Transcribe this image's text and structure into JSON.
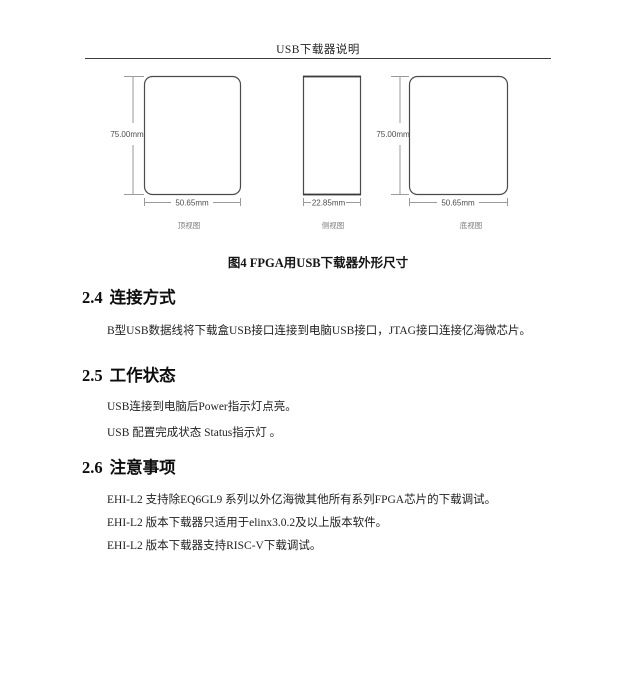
{
  "header": {
    "title": "USB下载器说明"
  },
  "figure": {
    "caption": "图4 FPGA用USB下载器外形尺寸",
    "views": [
      {
        "label": "顶视图",
        "width": "50.65mm",
        "height": "75.00mm"
      },
      {
        "label": "侧视图",
        "width": "22.85mm"
      },
      {
        "label": "底视图",
        "width": "50.65mm",
        "height": "75.00mm"
      }
    ]
  },
  "sections": [
    {
      "number": "2.4",
      "title": "连接方式",
      "paragraphs": [
        "B型USB数据线将下载盒USB接口连接到电脑USB接口，JTAG接口连接亿海微芯片。"
      ]
    },
    {
      "number": "2.5",
      "title": "工作状态",
      "paragraphs": [
        "USB连接到电脑后Power指示灯点亮。",
        "USB 配置完成状态 Status指示灯 。"
      ]
    },
    {
      "number": "2.6",
      "title": "注意事项",
      "paragraphs": [
        "EHI-L2 支持除EQ6GL9 系列以外亿海微其他所有系列FPGA芯片的下载调试。",
        "EHI-L2 版本下载器只适用于elinx3.0.2及以上版本软件。",
        "EHI-L2 版本下载器支持RISC-V下载调试。"
      ]
    }
  ],
  "colors": {
    "page_background": "#ffffff",
    "ink": "#1c1c1c",
    "diagram_outline": "#4a4a4a",
    "dimension_line": "#9a9a9a"
  }
}
